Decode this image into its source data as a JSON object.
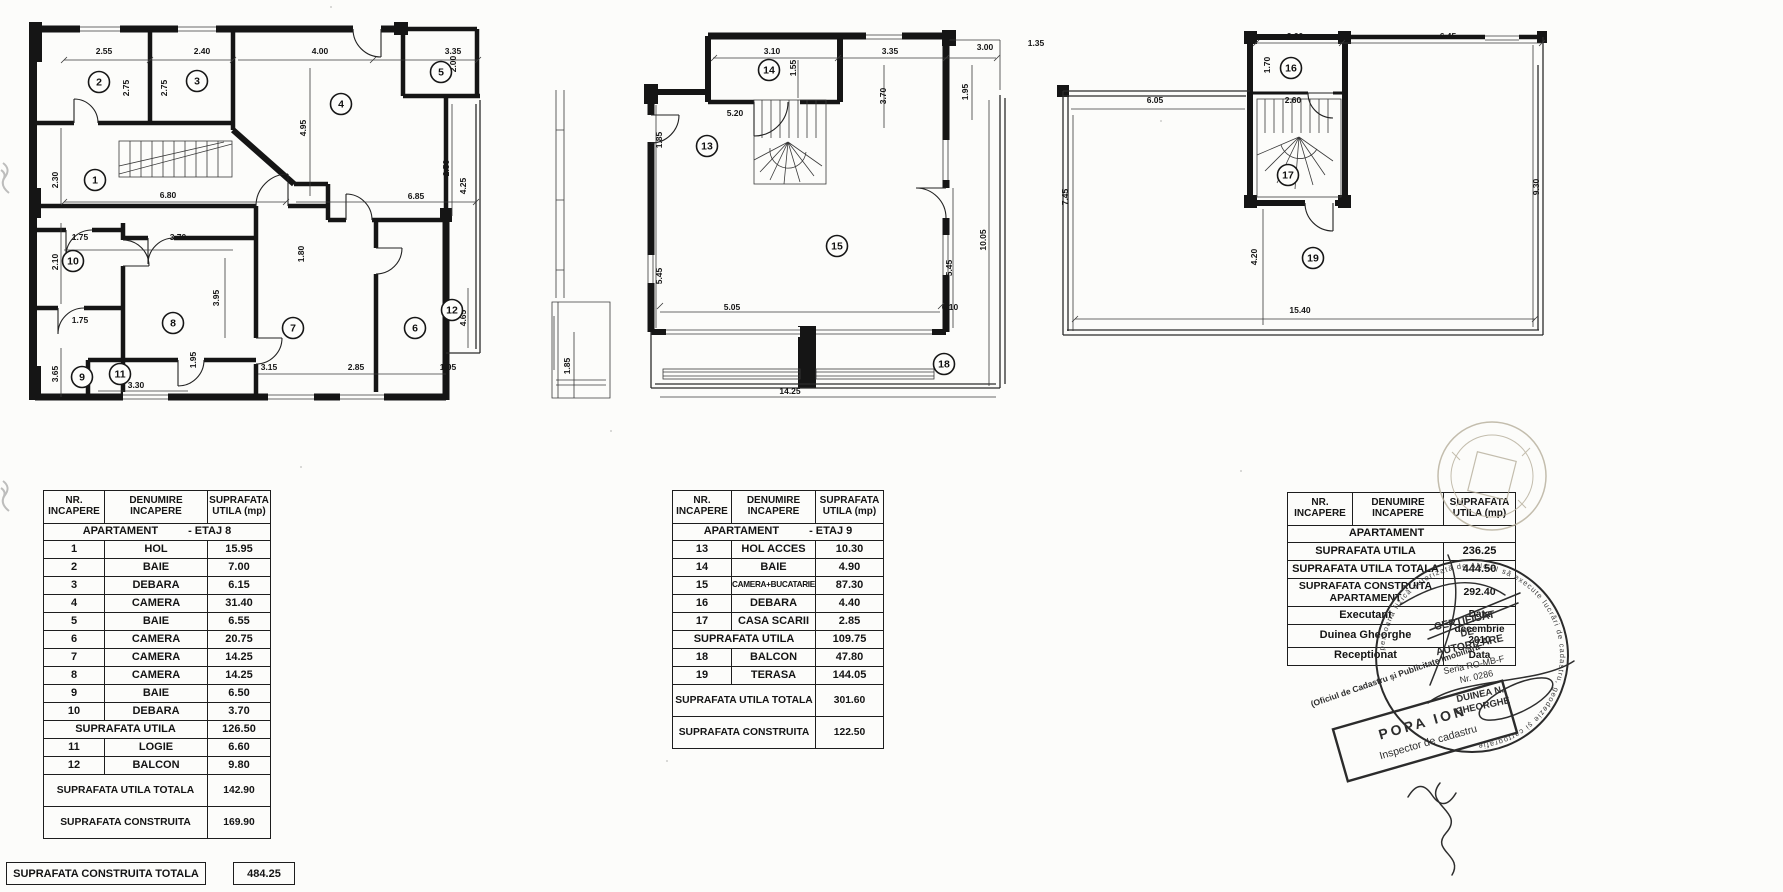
{
  "plans": [
    {
      "name": "plan-etaj-8",
      "rooms": [
        {
          "n": "2",
          "x": 71,
          "y": 74
        },
        {
          "n": "3",
          "x": 169,
          "y": 73
        },
        {
          "n": "4",
          "x": 313,
          "y": 96
        },
        {
          "n": "5",
          "x": 413,
          "y": 64
        },
        {
          "n": "1",
          "x": 67,
          "y": 172
        },
        {
          "n": "10",
          "x": 45,
          "y": 253
        },
        {
          "n": "8",
          "x": 145,
          "y": 315
        },
        {
          "n": "7",
          "x": 265,
          "y": 320
        },
        {
          "n": "6",
          "x": 387,
          "y": 320
        },
        {
          "n": "9",
          "x": 54,
          "y": 369
        },
        {
          "n": "11",
          "x": 92,
          "y": 366
        },
        {
          "n": "12",
          "x": 424,
          "y": 302
        }
      ],
      "dims": [
        {
          "v": "2.55",
          "x": 76,
          "y": 46
        },
        {
          "v": "2.40",
          "x": 174,
          "y": 46
        },
        {
          "v": "4.00",
          "x": 292,
          "y": 46
        },
        {
          "v": "3.35",
          "x": 425,
          "y": 46
        },
        {
          "v": "2.75",
          "x": 101,
          "y": 80,
          "r": 1
        },
        {
          "v": "2.75",
          "x": 139,
          "y": 80,
          "r": 1
        },
        {
          "v": "4.95",
          "x": 278,
          "y": 120,
          "r": 1
        },
        {
          "v": "2.00",
          "x": 428,
          "y": 56,
          "r": 1
        },
        {
          "v": "2.30",
          "x": 30,
          "y": 172,
          "r": 1
        },
        {
          "v": "6.80",
          "x": 140,
          "y": 190
        },
        {
          "v": "6.85",
          "x": 388,
          "y": 191
        },
        {
          "v": "2.50",
          "x": 421,
          "y": 160,
          "r": 1
        },
        {
          "v": "4.25",
          "x": 438,
          "y": 178,
          "r": 1
        },
        {
          "v": "1.75",
          "x": 52,
          "y": 232
        },
        {
          "v": "3.70",
          "x": 150,
          "y": 232
        },
        {
          "v": "2.10",
          "x": 30,
          "y": 254,
          "r": 1
        },
        {
          "v": "1.80",
          "x": 276,
          "y": 246,
          "r": 1
        },
        {
          "v": "3.95",
          "x": 191,
          "y": 290,
          "r": 1
        },
        {
          "v": "1.75",
          "x": 52,
          "y": 315
        },
        {
          "v": "6.20",
          "x": 392,
          "y": 320,
          "r": 1
        },
        {
          "v": "4.65",
          "x": 438,
          "y": 310,
          "r": 1
        },
        {
          "v": "3.65",
          "x": 30,
          "y": 366,
          "r": 1
        },
        {
          "v": "1.95",
          "x": 168,
          "y": 352,
          "r": 1
        },
        {
          "v": "3.30",
          "x": 108,
          "y": 380
        },
        {
          "v": "3.15",
          "x": 241,
          "y": 362
        },
        {
          "v": "2.85",
          "x": 328,
          "y": 362
        },
        {
          "v": "1.95",
          "x": 420,
          "y": 362
        }
      ]
    },
    {
      "name": "plan-etaj-9",
      "rooms": [
        {
          "n": "14",
          "x": 221,
          "y": 50
        },
        {
          "n": "13",
          "x": 159,
          "y": 126
        },
        {
          "n": "15",
          "x": 289,
          "y": 226
        },
        {
          "n": "18",
          "x": 396,
          "y": 344
        }
      ],
      "dims": [
        {
          "v": "3.10",
          "x": 224,
          "y": 34
        },
        {
          "v": "3.35",
          "x": 342,
          "y": 34
        },
        {
          "v": "3.00",
          "x": 437,
          "y": 30
        },
        {
          "v": "1.35",
          "x": 488,
          "y": 26
        },
        {
          "v": "1.55",
          "x": 248,
          "y": 48,
          "r": 1
        },
        {
          "v": "5.20",
          "x": 187,
          "y": 96
        },
        {
          "v": "1.85",
          "x": 114,
          "y": 120,
          "r": 1
        },
        {
          "v": "3.70",
          "x": 338,
          "y": 76,
          "r": 1
        },
        {
          "v": "1.95",
          "x": 420,
          "y": 72,
          "r": 1
        },
        {
          "v": "5.45",
          "x": 114,
          "y": 256,
          "r": 1
        },
        {
          "v": "5.45",
          "x": 404,
          "y": 248,
          "r": 1
        },
        {
          "v": "10.05",
          "x": 438,
          "y": 220,
          "r": 1
        },
        {
          "v": "5.05",
          "x": 184,
          "y": 290
        },
        {
          "v": "6.10",
          "x": 402,
          "y": 290
        },
        {
          "v": "1.85",
          "x": 22,
          "y": 346,
          "r": 1
        },
        {
          "v": "14.25",
          "x": 242,
          "y": 374
        }
      ]
    },
    {
      "name": "plan-terasa",
      "rooms": [
        {
          "n": "16",
          "x": 236,
          "y": 43
        },
        {
          "n": "17",
          "x": 233,
          "y": 150
        },
        {
          "n": "19",
          "x": 258,
          "y": 233
        }
      ],
      "dims": [
        {
          "v": "2.60",
          "x": 240,
          "y": 14
        },
        {
          "v": "6.45",
          "x": 393,
          "y": 14
        },
        {
          "v": "1.70",
          "x": 215,
          "y": 40,
          "r": 1
        },
        {
          "v": "6.05",
          "x": 100,
          "y": 78
        },
        {
          "v": "2.60",
          "x": 238,
          "y": 78
        },
        {
          "v": "7.45",
          "x": 13,
          "y": 172,
          "r": 1
        },
        {
          "v": "4.20",
          "x": 202,
          "y": 232,
          "r": 1
        },
        {
          "v": "9.30",
          "x": 484,
          "y": 162,
          "r": 1
        },
        {
          "v": "15.40",
          "x": 245,
          "y": 288
        }
      ]
    }
  ],
  "tables": [
    {
      "headers": [
        "NR.\nINCAPERE",
        "DENUMIRE\nINCAPERE",
        "SUPRAFATA\nUTILA (mp)"
      ],
      "rows": [
        {
          "t": "sec",
          "a": "APARTAMENT",
          "b": "- ETAJ 8"
        },
        {
          "t": "r",
          "n": "1",
          "d": "HOL",
          "s": "15.95"
        },
        {
          "t": "r",
          "n": "2",
          "d": "BAIE",
          "s": "7.00"
        },
        {
          "t": "r",
          "n": "3",
          "d": "DEBARA",
          "s": "6.15"
        },
        {
          "t": "r",
          "n": "4",
          "d": "CAMERA",
          "s": "31.40"
        },
        {
          "t": "r",
          "n": "5",
          "d": "BAIE",
          "s": "6.55"
        },
        {
          "t": "r",
          "n": "6",
          "d": "CAMERA",
          "s": "20.75"
        },
        {
          "t": "r",
          "n": "7",
          "d": "CAMERA",
          "s": "14.25"
        },
        {
          "t": "r",
          "n": "8",
          "d": "CAMERA",
          "s": "14.25"
        },
        {
          "t": "r",
          "n": "9",
          "d": "BAIE",
          "s": "6.50"
        },
        {
          "t": "r",
          "n": "10",
          "d": "DEBARA",
          "s": "3.70"
        },
        {
          "t": "sum",
          "l": "SUPRAFATA UTILA",
          "s": "126.50"
        },
        {
          "t": "r",
          "n": "11",
          "d": "LOGIE",
          "s": "6.60"
        },
        {
          "t": "r",
          "n": "12",
          "d": "BALCON",
          "s": "9.80"
        },
        {
          "t": "big",
          "l": "SUPRAFATA UTILA TOTALA",
          "s": "142.90"
        },
        {
          "t": "big",
          "l": "SUPRAFATA CONSTRUITA",
          "s": "169.90"
        }
      ]
    },
    {
      "headers": [
        "NR.\nINCAPERE",
        "DENUMIRE\nINCAPERE",
        "SUPRAFATA\nUTILA (mp)"
      ],
      "rows": [
        {
          "t": "sec",
          "a": "APARTAMENT",
          "b": "- ETAJ 9"
        },
        {
          "t": "r",
          "n": "13",
          "d": "HOL ACCES",
          "s": "10.30"
        },
        {
          "t": "r",
          "n": "14",
          "d": "BAIE",
          "s": "4.90"
        },
        {
          "t": "r",
          "n": "15",
          "d": "CAMERA+BUCATARIE",
          "s": "87.30"
        },
        {
          "t": "r",
          "n": "16",
          "d": "DEBARA",
          "s": "4.40"
        },
        {
          "t": "r",
          "n": "17",
          "d": "CASA SCARII",
          "s": "2.85"
        },
        {
          "t": "sum",
          "l": "SUPRAFATA UTILA",
          "s": "109.75"
        },
        {
          "t": "r",
          "n": "18",
          "d": "BALCON",
          "s": "47.80"
        },
        {
          "t": "r",
          "n": "19",
          "d": "TERASA",
          "s": "144.05"
        },
        {
          "t": "big",
          "l": "SUPRAFATA UTILA TOTALA",
          "s": "301.60"
        },
        {
          "t": "big",
          "l": "SUPRAFATA CONSTRUITA",
          "s": "122.50"
        }
      ]
    },
    {
      "headers": [
        "NR.\nINCAPERE",
        "DENUMIRE\nINCAPERE",
        "SUPRAFATA\nUTILA (mp)"
      ],
      "rows": [
        {
          "t": "sec",
          "a": "APARTAMENT",
          "b": ""
        },
        {
          "t": "sum",
          "l": "SUPRAFATA UTILA",
          "s": "236.25"
        },
        {
          "t": "sum",
          "l": "SUPRAFATA UTILA TOTALA",
          "s": "444.50"
        },
        {
          "t": "big2",
          "l": "SUPRAFATA CONSTRUITA\nAPARTAMENT",
          "s": "292.40"
        },
        {
          "t": "kv",
          "l": "Executant",
          "s": "Data"
        },
        {
          "t": "kv",
          "l": "Duinea Gheorghe",
          "s": "decembrie 2010"
        },
        {
          "t": "kv",
          "l": "Receptionat",
          "s": "Data"
        }
      ]
    }
  ],
  "footer_total": {
    "label": "SUPRAFATA CONSTRUITA TOTALA",
    "value": "484.25"
  },
  "stamps": {
    "certificate": {
      "title_l1": "CERTIFICAT",
      "title_l2": "DE",
      "title_l3": "AUTORIZARE",
      "seria": "Seria RO-MB-F",
      "nr": "Nr. 0286",
      "name_l1": "DUINEA N.",
      "name_l2": "GHEORGHE",
      "rim_text": "persoană fizică autorizată de ANCPI să execute lucrări de cadastru, geodezie și cartografie"
    },
    "office_text": "(Oficiul de Cadastru și Publicitate Imobiliară",
    "inspector": {
      "name": "POPA ION",
      "title": "Inspector de cadastru"
    }
  }
}
